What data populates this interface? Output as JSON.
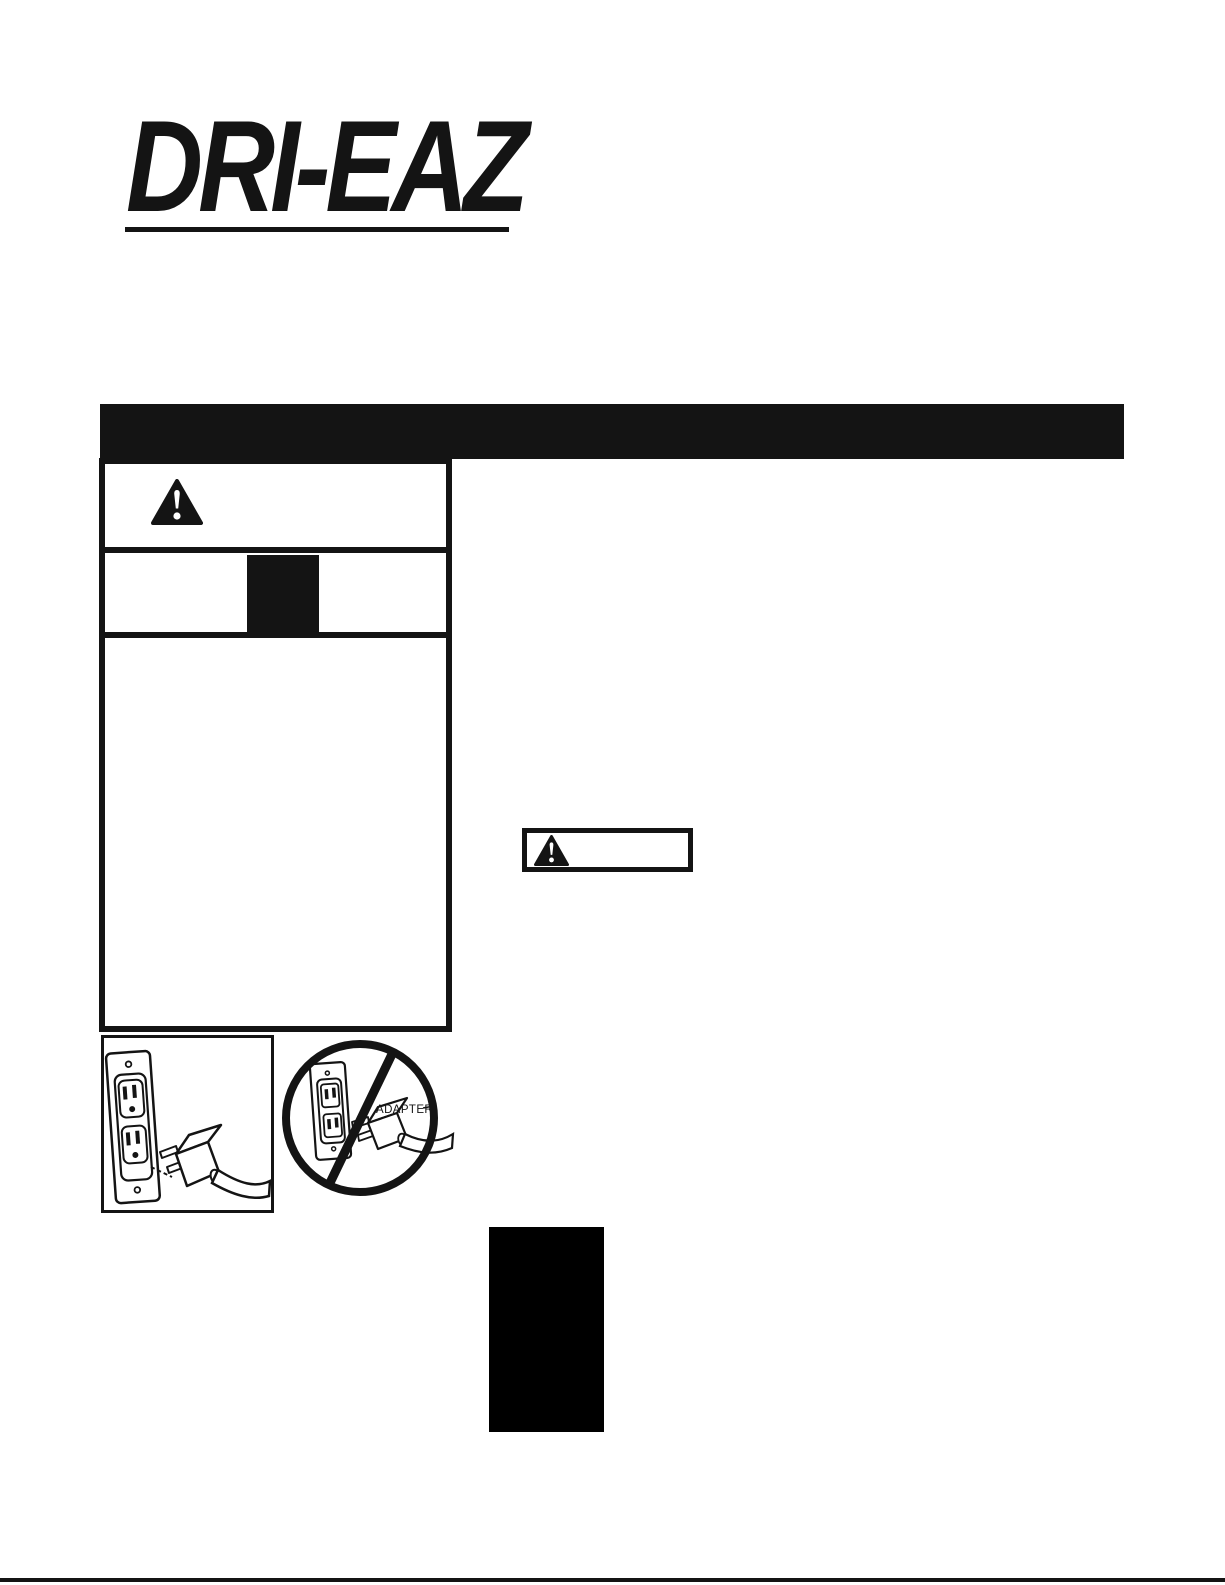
{
  "colors": {
    "ink": "#141414",
    "paper": "#ffffff"
  },
  "logo": {
    "text": "DRI-EAZ"
  },
  "figures": {
    "adapter": {
      "label": "ADAPTER"
    }
  }
}
